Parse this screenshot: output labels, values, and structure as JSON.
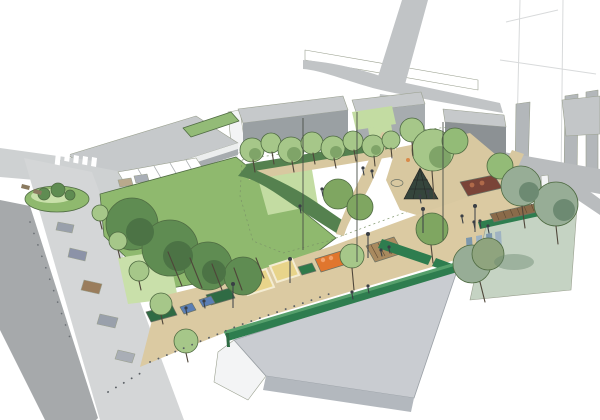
{
  "scene": {
    "kind": "architectural-aerial-perspective-sketch",
    "subject": "urban park masterplan with central lawn, playground, plaza strip, street with parking and surrounding buildings"
  },
  "colors": {
    "canvas": "#ffffff",
    "roadGray": "#c1c4c6",
    "roadLight": "#ced1d2",
    "roadDark": "#a6a9ab",
    "rampGray": "#b9bcbe",
    "streetGray": "#d4d6d7",
    "roofGray": "#c6c9cb",
    "facadeGray": "#9aa0a3",
    "facadeDark": "#8c9194",
    "bandGray": "#a7acaf",
    "bandWhite": "#eceeee",
    "buildingWhite": "#f3f4f5",
    "towerFin": "#b3b7ba",
    "towerSlab": "#c3c6c8",
    "foreRoof": "#c9ccd1",
    "foreFascia": "#b3b8be",
    "lawnLight": "#cfe3ae",
    "lawnMid": "#c3dca2",
    "bermGreen": "#8fb96e",
    "bermLight": "#c9e0aa",
    "treeLight": "#a6c789",
    "treeShadow": "#7fa468",
    "treeMid": "#93bb77",
    "treeDark": "#5f8c52",
    "treeDarker": "#4c7345",
    "treeDull": "#7fa661",
    "hedgeDark": "#55814f",
    "sageTree": "#97ad96",
    "sageShadow": "#6d8a72",
    "oliveTree": "#8fa47e",
    "sageGround": "#c5d3c3",
    "greenWall": "#2e7d4f",
    "greenWallTop": "#56a06c",
    "planterGreen": "#2f6b44",
    "plazaTan": "#dbcaa2",
    "pathTan": "#d8c8a0",
    "sandYellow": "#e8d48a",
    "playOrange": "#e0762e",
    "playRedBrown": "#7a4438",
    "playRedItem": "#b06a4a",
    "deckBrown": "#a98a5f",
    "pergolaBrown": "#8a6b4a",
    "tableBlue": "#5b7fb5",
    "tableGreen": "#2f7a4a",
    "carGray": "#99a0ab",
    "carBlue": "#8c93a8",
    "carBrown": "#9a7d5c",
    "carBeige": "#b9a98c",
    "carSilver": "#a9aeb6",
    "benchWood": "#8a7a5f",
    "figureDark": "#3a3f45",
    "glassBlue": "#7d98ad",
    "glassBlue2": "#9fb3c2"
  }
}
